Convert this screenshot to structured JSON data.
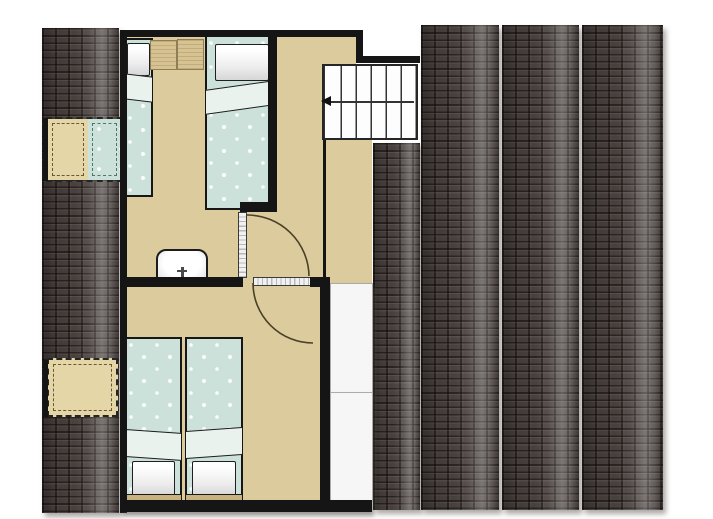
{
  "palette": {
    "floor": "#DCCB9D",
    "wall": "#151515",
    "roof-dark": "#49413E",
    "roof-light": "#837A76",
    "bed-duvet": "#CBE1DA",
    "bed-fold": "#EAF2EE",
    "pillow": "#FAFAFA",
    "skylight-tan": "#E5D6A8",
    "panel-white": "#F6F6F6",
    "mat": "#D7C392",
    "door-arc": "#4A4128"
  },
  "scene": {
    "type": "attic-floor-plan",
    "text_visible": "none",
    "rooms": [
      {
        "id": "bedroom-top",
        "furniture": [
          "single-bed",
          "single-bed",
          "bedside-mat",
          "bedside-mat",
          "wash-basin"
        ],
        "doors": 1
      },
      {
        "id": "landing",
        "furniture": [
          "staircase"
        ],
        "doors": 0
      },
      {
        "id": "bedroom-bottom",
        "furniture": [
          "single-bed",
          "single-bed"
        ],
        "doors": 1
      }
    ],
    "stairs": {
      "treads": 6,
      "direction_arrow": "left"
    },
    "doors": [
      {
        "room": "bedroom-top",
        "symbol": "leaf-with-quarter-arc"
      },
      {
        "room": "bedroom-bottom",
        "symbol": "leaf-with-quarter-arc"
      }
    ],
    "skylights": [
      {
        "position": "left-roof-upper",
        "panes": [
          "tan",
          "bed-blue"
        ]
      },
      {
        "position": "left-roof-lower",
        "panes": [
          "tan"
        ]
      }
    ],
    "roof": {
      "left_strips": 1,
      "right_strips": 4,
      "texture": "tile-rows",
      "dormer_panels": 2
    }
  }
}
